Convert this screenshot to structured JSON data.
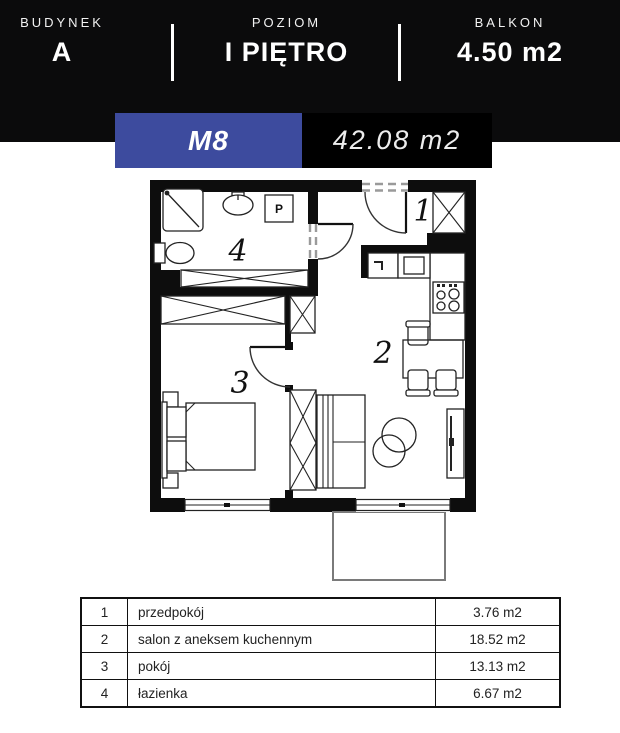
{
  "header": {
    "sections": [
      {
        "label": "BUDYNEK",
        "value": "A"
      },
      {
        "label": "POZIOM",
        "value": "I PIĘTRO"
      },
      {
        "label": "BALKON",
        "value": "4.50 m2"
      }
    ]
  },
  "unit": {
    "code": "M8",
    "area": "42.08 m2"
  },
  "colors": {
    "accent": "#3d4b9e",
    "header_bg": "#0b0b0c"
  },
  "floorplan": {
    "room_numbers": {
      "hall": "1",
      "living": "2",
      "bedroom": "3",
      "bathroom": "4"
    },
    "washer_label": "P"
  },
  "rooms_table": {
    "rows": [
      {
        "no": "1",
        "name": "przedpokój",
        "area": "3.76 m2"
      },
      {
        "no": "2",
        "name": "salon z aneksem kuchennym",
        "area": "18.52 m2"
      },
      {
        "no": "3",
        "name": "pokój",
        "area": "13.13 m2"
      },
      {
        "no": "4",
        "name": "łazienka",
        "area": "6.67 m2"
      }
    ]
  }
}
